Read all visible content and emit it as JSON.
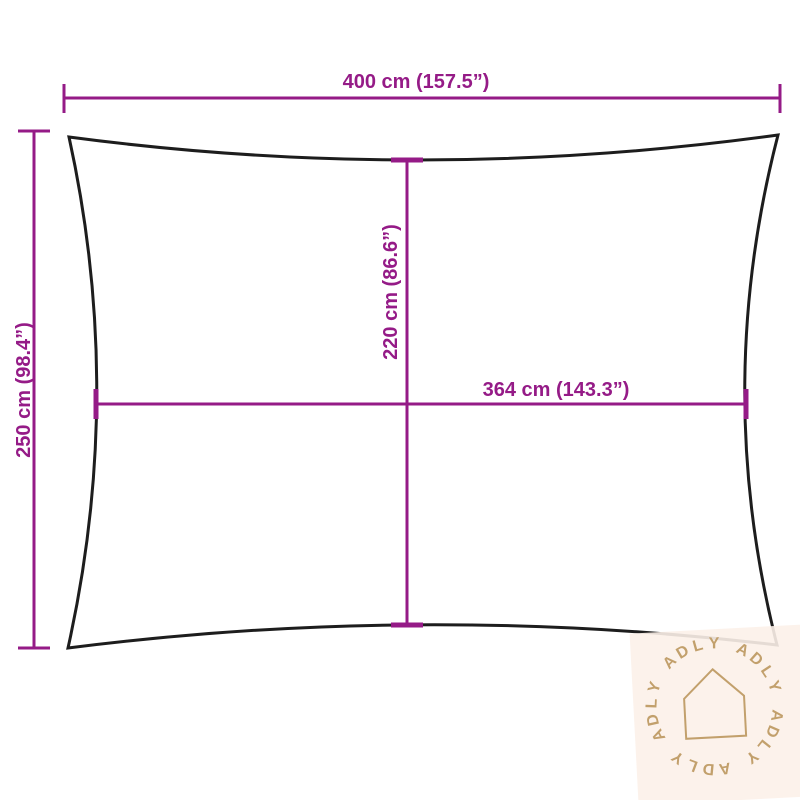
{
  "product_diagram": {
    "type": "sun-shade-sail-dimension-diagram",
    "dimensions": {
      "top_width": {
        "label": "400 cm (157.5”)"
      },
      "left_height": {
        "label": "250 cm (98.4”)"
      },
      "center_height": {
        "label": "220 cm (86.6”)"
      },
      "center_width": {
        "label": "364 cm (143.3”)"
      }
    },
    "colors": {
      "dimension_line": "#951b87",
      "sail_outline": "#1d1d1d",
      "watermark_background": "#fcf1e9",
      "watermark_foreground": "#c2a06c"
    },
    "watermark": {
      "brand": "ADLY",
      "icon": "house-icon"
    }
  }
}
